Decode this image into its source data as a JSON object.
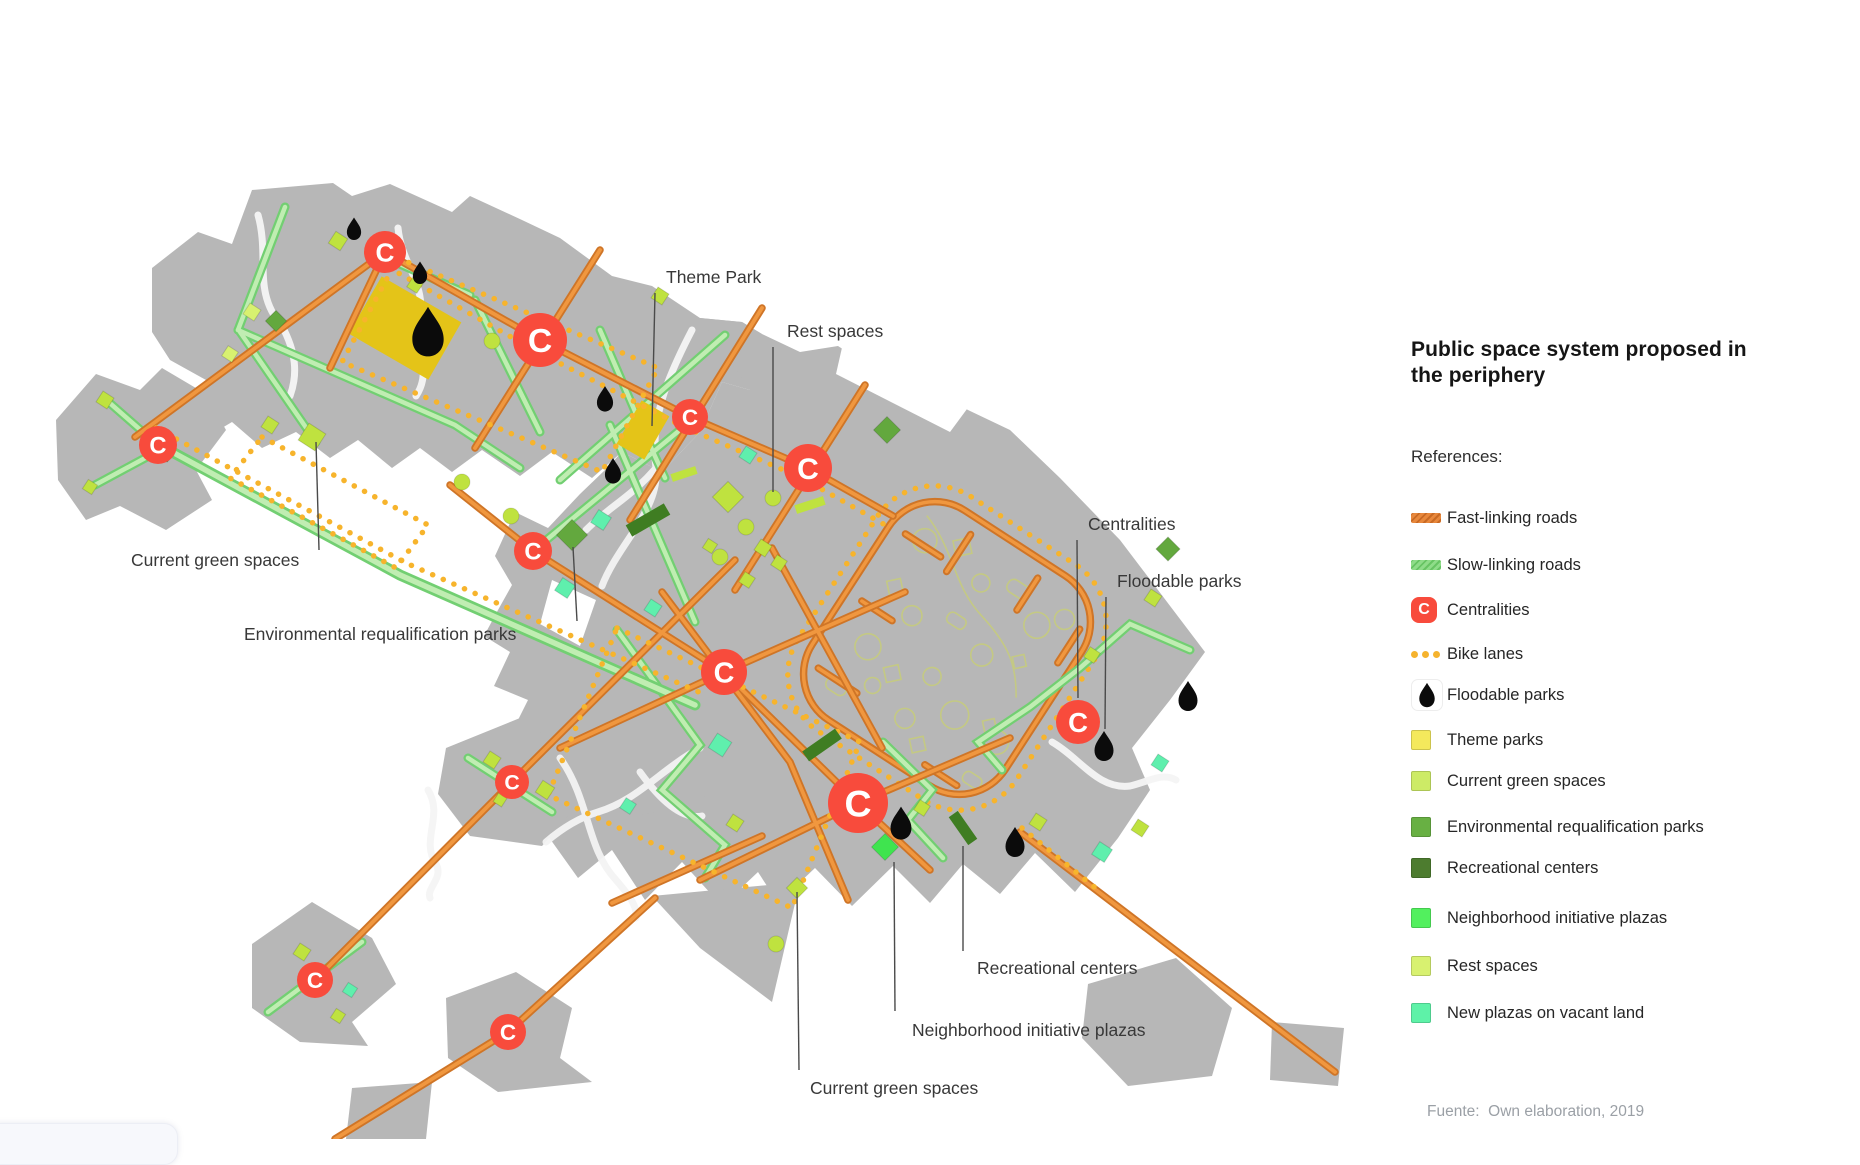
{
  "legend": {
    "title": "Public space system proposed in the periphery",
    "references_label": "References:",
    "items": [
      {
        "label": "Fast-linking roads",
        "type": "road",
        "color": "#e8883c",
        "stripe": "#c96a24",
        "y": 503
      },
      {
        "label": "Slow-linking roads",
        "type": "road",
        "color": "#8fdc89",
        "stripe": "#67c463",
        "y": 550
      },
      {
        "label": "Centralities",
        "type": "badge",
        "color": "#f84b3c",
        "letter": "C",
        "y": 595
      },
      {
        "label": "Bike lanes",
        "type": "dots",
        "color": "#f5b32e",
        "y": 639
      },
      {
        "label": "Floodable parks",
        "type": "drop",
        "color": "#0b0b0b",
        "y": 680
      },
      {
        "label": "Theme parks",
        "type": "square",
        "color": "#f4e95c",
        "y": 725
      },
      {
        "label": "Current green spaces",
        "type": "square",
        "color": "#cdeb66",
        "y": 766
      },
      {
        "label": "Environmental requalification parks",
        "type": "square",
        "color": "#68b043",
        "y": 812
      },
      {
        "label": "Recreational centers",
        "type": "square",
        "color": "#4d7c2f",
        "y": 853
      },
      {
        "label": "Neighborhood initiative plazas",
        "type": "square",
        "color": "#52f05e",
        "y": 903
      },
      {
        "label": "Rest spaces",
        "type": "square",
        "color": "#d8f170",
        "y": 951
      },
      {
        "label": "New plazas on vacant land",
        "type": "square",
        "color": "#5ef2a8",
        "y": 998
      }
    ]
  },
  "source_note": "Fuente:  Own elaboration, 2019",
  "colors": {
    "fast_road": "#e8883c",
    "slow_road": "#8fdc89",
    "bike_lane": "#f7b42c",
    "centrality": "#f84b3c",
    "floodable": "#0b0b0b",
    "theme_park": "#e4c418",
    "current": "#bfe23f",
    "rest": "#d8f170",
    "environmental": "#63a83e",
    "recreational": "#3f7d22",
    "neighborhood": "#3fe44f",
    "new_plaza": "#5fefad",
    "urban_gray": "#b7b7b7"
  },
  "map": {
    "centrality_letter": "C",
    "centralities": [
      {
        "x": 385,
        "y": 252,
        "r": 21
      },
      {
        "x": 540,
        "y": 340,
        "r": 27
      },
      {
        "x": 158,
        "y": 445,
        "r": 19
      },
      {
        "x": 690,
        "y": 417,
        "r": 18
      },
      {
        "x": 808,
        "y": 468,
        "r": 24
      },
      {
        "x": 533,
        "y": 551,
        "r": 19
      },
      {
        "x": 724,
        "y": 672,
        "r": 23
      },
      {
        "x": 858,
        "y": 803,
        "r": 30
      },
      {
        "x": 1078,
        "y": 722,
        "r": 22
      },
      {
        "x": 512,
        "y": 782,
        "r": 17
      },
      {
        "x": 315,
        "y": 980,
        "r": 18
      },
      {
        "x": 508,
        "y": 1032,
        "r": 18
      }
    ],
    "floodable": [
      {
        "x": 354,
        "y": 228,
        "s": 0.75
      },
      {
        "x": 420,
        "y": 272,
        "s": 0.75
      },
      {
        "x": 428,
        "y": 330,
        "s": 1.65
      },
      {
        "x": 605,
        "y": 398,
        "s": 0.85
      },
      {
        "x": 613,
        "y": 470,
        "s": 0.85
      },
      {
        "x": 901,
        "y": 822,
        "s": 1.1
      },
      {
        "x": 1015,
        "y": 841,
        "s": 1.0
      },
      {
        "x": 1104,
        "y": 745,
        "s": 1.0
      },
      {
        "x": 1188,
        "y": 695,
        "s": 1.0
      }
    ],
    "theme_parks": [
      {
        "x": 405,
        "y": 328,
        "w": 92,
        "h": 66,
        "r": 30
      },
      {
        "x": 643,
        "y": 430,
        "w": 32,
        "h": 50,
        "r": 30
      }
    ],
    "squares": [
      {
        "x": 312,
        "y": 437,
        "s": 20,
        "r": 33,
        "k": "current"
      },
      {
        "x": 270,
        "y": 425,
        "s": 13,
        "r": 33,
        "k": "current"
      },
      {
        "x": 105,
        "y": 400,
        "s": 13,
        "r": 33,
        "k": "current"
      },
      {
        "x": 90,
        "y": 487,
        "s": 11,
        "r": 33,
        "k": "current"
      },
      {
        "x": 338,
        "y": 241,
        "s": 14,
        "r": 33,
        "k": "current"
      },
      {
        "x": 415,
        "y": 285,
        "s": 12,
        "r": 33,
        "k": "current"
      },
      {
        "x": 660,
        "y": 296,
        "s": 13,
        "r": 33,
        "k": "current"
      },
      {
        "x": 728,
        "y": 497,
        "s": 22,
        "r": 45,
        "k": "current"
      },
      {
        "x": 763,
        "y": 548,
        "s": 13,
        "r": 33,
        "k": "current"
      },
      {
        "x": 779,
        "y": 563,
        "s": 12,
        "r": 33,
        "k": "current"
      },
      {
        "x": 747,
        "y": 580,
        "s": 12,
        "r": 33,
        "k": "current"
      },
      {
        "x": 710,
        "y": 546,
        "s": 11,
        "r": 33,
        "k": "current"
      },
      {
        "x": 545,
        "y": 790,
        "s": 14,
        "r": 33,
        "k": "current"
      },
      {
        "x": 735,
        "y": 823,
        "s": 13,
        "r": 33,
        "k": "current"
      },
      {
        "x": 797,
        "y": 888,
        "s": 15,
        "r": 45,
        "k": "current"
      },
      {
        "x": 922,
        "y": 808,
        "s": 12,
        "r": 33,
        "k": "current"
      },
      {
        "x": 1038,
        "y": 822,
        "s": 13,
        "r": 33,
        "k": "current"
      },
      {
        "x": 1140,
        "y": 828,
        "s": 13,
        "r": 33,
        "k": "current"
      },
      {
        "x": 1092,
        "y": 655,
        "s": 12,
        "r": 33,
        "k": "current"
      },
      {
        "x": 1153,
        "y": 598,
        "s": 13,
        "r": 33,
        "k": "current"
      },
      {
        "x": 302,
        "y": 952,
        "s": 13,
        "r": 33,
        "k": "current"
      },
      {
        "x": 338,
        "y": 1016,
        "s": 11,
        "r": 33,
        "k": "current"
      },
      {
        "x": 492,
        "y": 760,
        "s": 13,
        "r": 33,
        "k": "current"
      },
      {
        "x": 500,
        "y": 800,
        "s": 10,
        "r": 33,
        "k": "current"
      },
      {
        "x": 252,
        "y": 312,
        "s": 13,
        "r": 33,
        "k": "rest"
      },
      {
        "x": 230,
        "y": 354,
        "s": 12,
        "r": 33,
        "k": "rest"
      },
      {
        "x": 601,
        "y": 520,
        "s": 15,
        "r": 33,
        "k": "new_plaza"
      },
      {
        "x": 565,
        "y": 588,
        "s": 15,
        "r": 33,
        "k": "new_plaza"
      },
      {
        "x": 653,
        "y": 608,
        "s": 13,
        "r": 33,
        "k": "new_plaza"
      },
      {
        "x": 720,
        "y": 745,
        "s": 17,
        "r": 33,
        "k": "new_plaza"
      },
      {
        "x": 1102,
        "y": 852,
        "s": 15,
        "r": 33,
        "k": "new_plaza"
      },
      {
        "x": 1160,
        "y": 763,
        "s": 13,
        "r": 33,
        "k": "new_plaza"
      },
      {
        "x": 350,
        "y": 990,
        "s": 11,
        "r": 33,
        "k": "new_plaza"
      },
      {
        "x": 748,
        "y": 455,
        "s": 13,
        "r": 33,
        "k": "new_plaza"
      },
      {
        "x": 628,
        "y": 806,
        "s": 12,
        "r": 33,
        "k": "new_plaza"
      },
      {
        "x": 572,
        "y": 535,
        "s": 22,
        "r": 45,
        "k": "environmental"
      },
      {
        "x": 887,
        "y": 430,
        "s": 19,
        "r": 45,
        "k": "environmental"
      },
      {
        "x": 1168,
        "y": 549,
        "s": 17,
        "r": 45,
        "k": "environmental"
      },
      {
        "x": 276,
        "y": 321,
        "s": 15,
        "r": 45,
        "k": "environmental"
      },
      {
        "x": 885,
        "y": 847,
        "s": 19,
        "r": 45,
        "k": "neighborhood"
      },
      {
        "x": 167,
        "y": 455,
        "s": 10,
        "r": 45,
        "k": "recreational"
      }
    ],
    "bars": [
      {
        "x": 648,
        "y": 520,
        "w": 13,
        "h": 44,
        "r": 60,
        "k": "recreational"
      },
      {
        "x": 822,
        "y": 745,
        "w": 12,
        "h": 40,
        "r": 55,
        "k": "recreational"
      },
      {
        "x": 963,
        "y": 828,
        "w": 11,
        "h": 34,
        "r": -35,
        "k": "recreational"
      },
      {
        "x": 810,
        "y": 505,
        "w": 30,
        "h": 9,
        "r": -18,
        "k": "current"
      },
      {
        "x": 684,
        "y": 474,
        "w": 26,
        "h": 8,
        "r": -18,
        "k": "current"
      }
    ],
    "circles": [
      {
        "x": 773,
        "y": 498
      },
      {
        "x": 746,
        "y": 527
      },
      {
        "x": 720,
        "y": 557
      },
      {
        "x": 776,
        "y": 944
      },
      {
        "x": 462,
        "y": 482
      },
      {
        "x": 511,
        "y": 516
      },
      {
        "x": 492,
        "y": 341
      }
    ],
    "annotations": [
      {
        "text": "Theme Park",
        "tx": 666,
        "ty": 283,
        "x1": 655,
        "y1": 293,
        "x2": 652,
        "y2": 426
      },
      {
        "text": "Rest spaces",
        "tx": 787,
        "ty": 337,
        "x1": 773,
        "y1": 347,
        "x2": 773,
        "y2": 492
      },
      {
        "text": "Centralities",
        "tx": 1088,
        "ty": 530,
        "x1": 1077,
        "y1": 540,
        "x2": 1078,
        "y2": 698
      },
      {
        "text": "Floodable parks",
        "tx": 1117,
        "ty": 587,
        "x1": 1106,
        "y1": 597,
        "x2": 1105,
        "y2": 729
      },
      {
        "text": "Current green spaces",
        "tx": 131,
        "ty": 566,
        "x1": 319,
        "y1": 550,
        "x2": 316,
        "y2": 442
      },
      {
        "text": "Environmental requalification parks",
        "tx": 244,
        "ty": 640,
        "x1": 577,
        "y1": 621,
        "x2": 573,
        "y2": 547
      },
      {
        "text": "Recreational centers",
        "tx": 977,
        "ty": 974,
        "x1": 963,
        "y1": 951,
        "x2": 963,
        "y2": 846
      },
      {
        "text": "Neighborhood initiative plazas",
        "tx": 912,
        "ty": 1036,
        "x1": 895,
        "y1": 1011,
        "x2": 894,
        "y2": 862
      },
      {
        "text": "Current green spaces",
        "tx": 810,
        "ty": 1094,
        "x1": 799,
        "y1": 1070,
        "x2": 797,
        "y2": 892
      }
    ]
  }
}
